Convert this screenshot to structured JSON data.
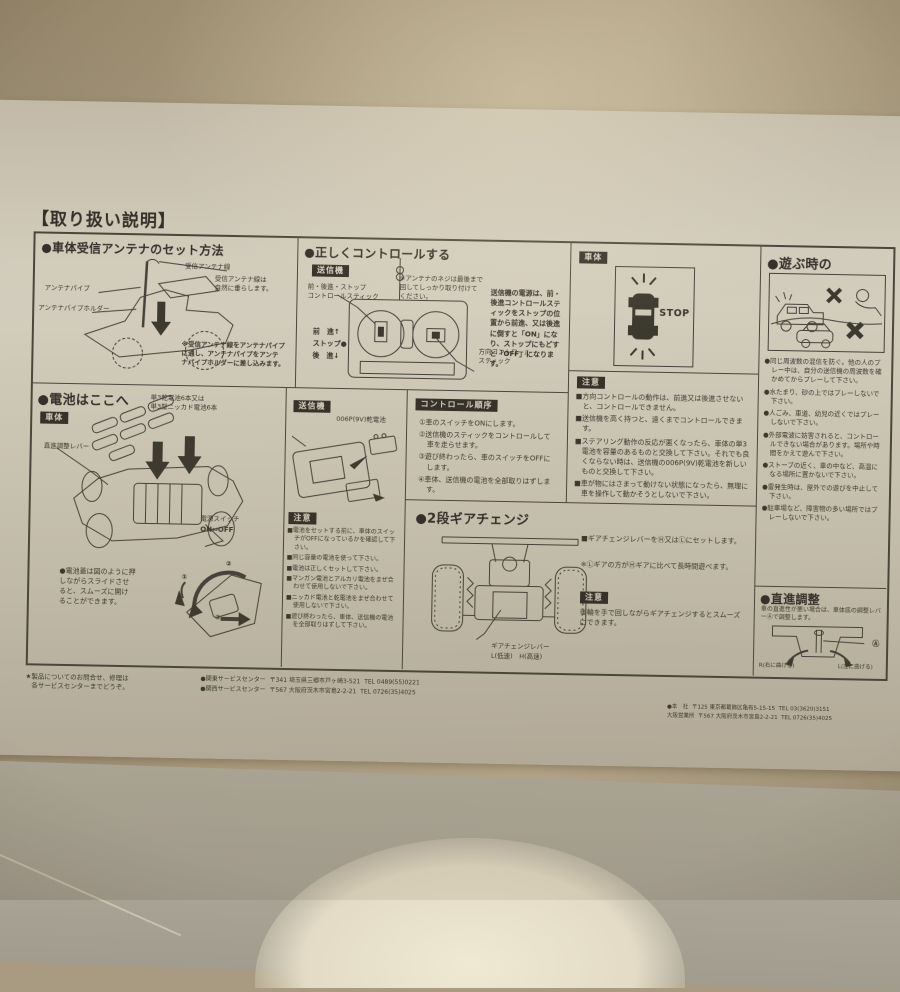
{
  "sheet": {
    "header": "【取り扱い説明】",
    "sections": {
      "antenna": {
        "title": "●車体受信アンテナのセット方法",
        "label_wire": "受信アンテナ線",
        "label_wire_note": "受信アンテナ線は\n自然に垂らします。",
        "label_pipe": "アンテナパイプ",
        "label_holder": "アンテナパイプホルダー",
        "note": "※受信アンテナ線をアンテナパイプ\nに通し、アンテナパイプをアンテ\nナパイプホルダーに差し込みます。"
      },
      "control": {
        "title": "●正しくコントロールする",
        "tag": "送信機",
        "stick_label": "前・後進・ストップ\nコントロールスティック",
        "screw_note": "※アンテナのネジは最後まで\n回してしっかり取り付けて\nください。",
        "legend": "前　進↑\nストップ●\n後　進↓",
        "dir_label": "方向コントロール\nスティック",
        "para": "送信機の電源は、前・後進コントロールスティックをストップの位置から前進、又は後進に倒すと「ON」になり、ストップにもどすと「OFF」になります。"
      },
      "stopbox": {
        "tag": "車体",
        "stop": "STOP"
      },
      "caution_control": {
        "tag": "注意",
        "items": [
          "■方向コントロールの動作は、前進又は後進させないと、コントロールできません。",
          "■送信機を高く持つと、遠くまでコントロールできます。",
          "■ステアリング動作の反応が悪くなったら、車体の単3電池を容量のあるものと交換して下さい。それでも良くならない時は、送信機の006P(9V)乾電池を新しいものと交換して下さい。",
          "■車が物にはさまって動けない状態になったら、無理に車を操作して動かそうとしないで下さい。"
        ]
      },
      "battery": {
        "title": "●電池はここへ",
        "tag": "車体",
        "batt_label": "単3乾電池6本又は\n単3型ニッカド電池6本",
        "lever_label": "直進調整レバー",
        "switch_label": "電源スイッチ",
        "switch_states": "ON⇔OFF",
        "lid_note": "●電池蓋は図のように押\nしながらスライドさせ\nると、スムーズに開け\nることができます。",
        "steps": [
          "①",
          "②",
          "③"
        ],
        "tx_tag": "送信機",
        "tx_batt_label": "006P(9V)乾電池",
        "caution_tag": "注意",
        "caution_items": [
          "■電池をセットする前に、車体のスイッチがOFFになっているかを確認して下さい。",
          "■同じ容量の電池を使って下さい。",
          "■電池は正しくセットして下さい。",
          "■マンガン電池とアルカリ電池をまぜ合わせて使用しないで下さい。",
          "■ニッカド電池と乾電池をまぜ合わせて使用しないで下さい。",
          "■遊び終わったら、車体、送信機の電池を全部取りはずして下さい。"
        ]
      },
      "sequence": {
        "tag": "コントロール順序",
        "items": [
          "①車のスイッチをONにします。",
          "②送信機のスティックをコントロールして車を走らせます。",
          "③遊び終わったら、車のスイッチをOFFにします。",
          "④車体、送信機の電池を全部取りはずします。"
        ]
      },
      "gear": {
        "title": "●2段ギアチェンジ",
        "lever_label": "ギアチェンジレバー",
        "lever_sub": "L(低速)　H(高速)",
        "item1": "■ギアチェンジレバーをⒽ又はⓁにセットします。",
        "item2": "※Ⓛギアの方がⒽギアに比べて長時間遊べます。",
        "caution_tag": "注意",
        "caution": "後輪を手で回しながらギアチェンジするとスムーズにできます。"
      },
      "play": {
        "title": "●遊ぶ時の",
        "items": [
          "●同じ周波数の混信を防ぐ。他の人のプレー中は、自分の送信機の周波数を確かめてからプレーして下さい。",
          "●水たまり、砂の上ではプレーしないで下さい。",
          "●人ごみ、車道、幼児の近くではプレーしないで下さい。",
          "●外部電波に妨害されると、コントロールできない場合があります。場所や時間をかえて遊んで下さい。",
          "●ストーブの近く、車の中など、高温になる場所に置かないで下さい。",
          "●雷発生時は、屋外での遊びを中止して下さい。",
          "●駐車場など、障害物の多い場所ではプレーしないで下さい。"
        ]
      },
      "straight": {
        "title": "●直進調整",
        "para": "車の直進性が悪い場合は、車体底の調整レバーⒶで調整します。",
        "label_a": "Ⓐ",
        "arrow_left": "R(右に曲げる)",
        "arrow_right": "L(左に曲げる)"
      }
    },
    "footer": {
      "note1": "★製品についてのお問合せ、修理は",
      "note2": "各サービスセンターまでどうぞ。",
      "kanto_name": "●関東サービスセンター",
      "kanto_addr": "〒341 埼玉県三郷市戸ヶ崎3-521",
      "kanto_tel": "TEL 0489(55)0221",
      "kansai_name": "●関西サービスセンター",
      "kansai_addr": "〒567 大阪府茨木市宮島2-2-21",
      "kansai_tel": "TEL 0726(35)4025",
      "hq_name": "●本　社",
      "hq_addr": "〒125 東京都葛飾区亀有5-15-15",
      "hq_tel": "TEL 03(3620)3151",
      "osaka_name": "大阪営業所",
      "osaka_addr": "〒567 大阪府茨木市宮島2-2-21",
      "osaka_tel": "TEL 0726(35)4025"
    }
  }
}
